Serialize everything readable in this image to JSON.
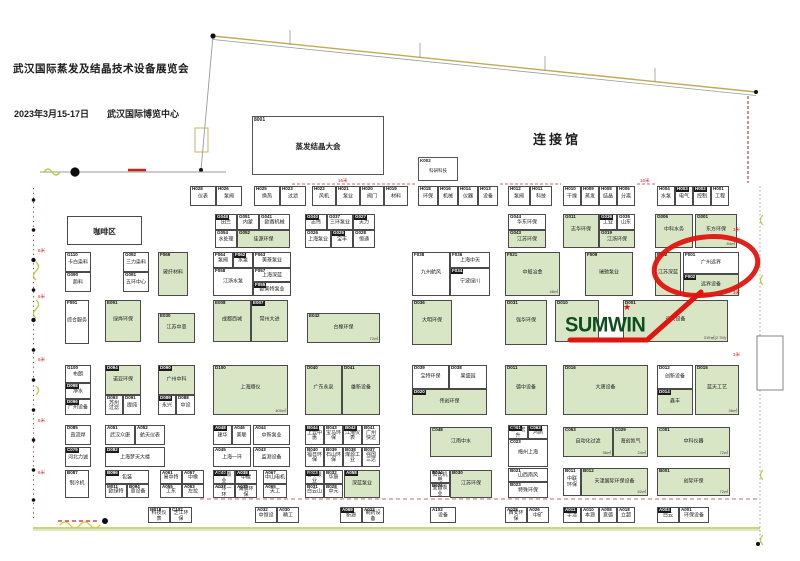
{
  "header": {
    "title": "武汉国际蒸发及结晶技术设备展览会",
    "date": "2023年3月15-17日",
    "venue": "武汉国际博览中心",
    "hall_label": "连接馆"
  },
  "conference": {
    "id": "8001",
    "name": "蒸发结晶大会"
  },
  "kbox": {
    "id": "K002",
    "name": "科研科技"
  },
  "sumwin": {
    "logo": "SUMWIN",
    "star_icon": "★"
  },
  "highlight": {
    "circled_booth": "F001",
    "circled_name": "广州远界"
  },
  "colors": {
    "booth_green": "#d9e6c6",
    "booth_border": "#4a4a4a",
    "highlight_red": "#e01410",
    "logo_green": "#0d4f1f",
    "edge_olive": "#b9c84c",
    "dashed_red": "#bb3333"
  },
  "measures": [
    [
      "16米",
      338,
      178
    ],
    [
      "16米",
      640,
      178
    ],
    [
      "6米",
      38,
      248
    ],
    [
      "6米",
      38,
      294
    ],
    [
      "6米",
      38,
      357
    ],
    [
      "6米",
      38,
      418
    ],
    [
      "6米",
      38,
      470
    ],
    [
      "3米",
      733,
      227
    ],
    [
      "3米",
      733,
      290
    ],
    [
      "3米",
      733,
      352
    ]
  ],
  "booths": [
    [
      "H028",
      "仪表",
      190,
      186,
      26,
      20,
      "w",
      0,
      ""
    ],
    [
      "H026",
      "泵阀",
      216,
      186,
      26,
      20,
      "w",
      0,
      ""
    ],
    [
      "H025",
      "换热",
      254,
      186,
      26,
      20,
      "w",
      0,
      ""
    ],
    [
      "H023",
      "过滤",
      280,
      186,
      26,
      20,
      "w",
      0,
      ""
    ],
    [
      "H022",
      "风机",
      312,
      186,
      24,
      20,
      "w",
      0,
      ""
    ],
    [
      "H021",
      "泵业",
      336,
      186,
      24,
      20,
      "w",
      0,
      ""
    ],
    [
      "H020",
      "阀门",
      360,
      186,
      24,
      20,
      "w",
      0,
      ""
    ],
    [
      "H019",
      "材料",
      384,
      186,
      24,
      20,
      "w",
      0,
      ""
    ],
    [
      "H018",
      "环保",
      418,
      186,
      20,
      20,
      "w",
      0,
      ""
    ],
    [
      "H016",
      "机械",
      438,
      186,
      20,
      20,
      "w",
      0,
      ""
    ],
    [
      "H014",
      "仪器",
      458,
      186,
      20,
      20,
      "w",
      0,
      ""
    ],
    [
      "H013",
      "设备",
      478,
      186,
      20,
      20,
      "w",
      0,
      ""
    ],
    [
      "H012",
      "泵阀",
      508,
      186,
      22,
      20,
      "w",
      0,
      ""
    ],
    [
      "H011",
      "科技",
      530,
      186,
      22,
      20,
      "w",
      0,
      ""
    ],
    [
      "H010",
      "干燥",
      563,
      186,
      18,
      20,
      "w",
      0,
      ""
    ],
    [
      "H009",
      "蒸发",
      581,
      186,
      18,
      20,
      "w",
      0,
      ""
    ],
    [
      "H008",
      "结晶",
      599,
      186,
      18,
      20,
      "w",
      0,
      ""
    ],
    [
      "H006",
      "分离",
      617,
      186,
      18,
      20,
      "w",
      0,
      ""
    ],
    [
      "H004",
      "水泵",
      657,
      186,
      18,
      20,
      "w",
      0,
      ""
    ],
    [
      "H003",
      "电气",
      675,
      186,
      18,
      20,
      "w",
      1,
      ""
    ],
    [
      "H002",
      "控制",
      693,
      186,
      18,
      20,
      "w",
      1,
      ""
    ],
    [
      "H001",
      "工程",
      711,
      186,
      18,
      20,
      "w",
      0,
      ""
    ],
    [
      "",
      "咖啡区",
      67,
      216,
      75,
      29,
      "w",
      2,
      ""
    ],
    [
      "G048",
      "田兰",
      215,
      214,
      22,
      16,
      "w",
      1,
      ""
    ],
    [
      "G051",
      "内蒙",
      237,
      214,
      22,
      16,
      "w",
      0,
      ""
    ],
    [
      "G041",
      "欧赛机械",
      259,
      214,
      31,
      16,
      "w",
      0,
      ""
    ],
    [
      "G054",
      "水处理",
      215,
      230,
      22,
      18,
      "w",
      0,
      ""
    ],
    [
      "G052",
      "佳源环保",
      237,
      230,
      53,
      18,
      "g",
      0,
      ""
    ],
    [
      "G040",
      "志伟",
      305,
      214,
      22,
      16,
      "w",
      1,
      ""
    ],
    [
      "G037",
      "三环泵业",
      327,
      214,
      26,
      16,
      "w",
      0,
      ""
    ],
    [
      "G027",
      "天力",
      353,
      214,
      22,
      16,
      "w",
      1,
      ""
    ],
    [
      "G026",
      "上海泵业",
      305,
      230,
      26,
      18,
      "w",
      0,
      ""
    ],
    [
      "G025",
      "宝丰",
      331,
      230,
      22,
      18,
      "w",
      1,
      ""
    ],
    [
      "G028",
      "恒通",
      353,
      230,
      22,
      18,
      "w",
      0,
      ""
    ],
    [
      "G044",
      "华东环保",
      508,
      214,
      38,
      16,
      "w",
      0,
      ""
    ],
    [
      "G043",
      "江苏环保",
      508,
      230,
      38,
      18,
      "g",
      0,
      ""
    ],
    [
      "G011",
      "志华环保",
      563,
      214,
      36,
      34,
      "g",
      0,
      ""
    ],
    [
      "G036",
      "工业",
      599,
      214,
      18,
      16,
      "w",
      1,
      ""
    ],
    [
      "G035",
      "山东",
      617,
      214,
      18,
      16,
      "w",
      0,
      ""
    ],
    [
      "G019",
      "江浙环保",
      599,
      230,
      36,
      18,
      "g",
      0,
      ""
    ],
    [
      "G006",
      "中科水务",
      655,
      214,
      38,
      34,
      "g",
      0,
      ""
    ],
    [
      "G001",
      "东方环保",
      695,
      214,
      42,
      34,
      "g",
      0,
      "84㎡"
    ],
    [
      "G110",
      "卡白染料",
      65,
      252,
      26,
      20,
      "w",
      0,
      ""
    ],
    [
      "G090",
      "颜料",
      65,
      272,
      26,
      20,
      "w",
      0,
      ""
    ],
    [
      "G092",
      "三力染料",
      123,
      252,
      26,
      20,
      "w",
      0,
      ""
    ],
    [
      "G091",
      "五环中心",
      123,
      272,
      26,
      20,
      "w",
      0,
      ""
    ],
    [
      "F069",
      "玻纤材料",
      158,
      252,
      30,
      44,
      "g",
      0,
      ""
    ],
    [
      "F064",
      "泵阀",
      213,
      252,
      20,
      16,
      "w",
      0,
      ""
    ],
    [
      "F062",
      "水泵",
      233,
      252,
      20,
      16,
      "w",
      1,
      ""
    ],
    [
      "F063",
      "美菱泵业",
      253,
      252,
      38,
      16,
      "w",
      0,
      ""
    ],
    [
      "F058",
      "江浙水泵",
      213,
      268,
      40,
      28,
      "w",
      0,
      ""
    ],
    [
      "F057",
      "上海深蓝",
      253,
      268,
      38,
      14,
      "w",
      0,
      ""
    ],
    [
      "F055",
      "欧美特泵业",
      253,
      282,
      38,
      14,
      "w",
      1,
      ""
    ],
    [
      "F038",
      "九州航风",
      412,
      252,
      38,
      44,
      "w",
      0,
      ""
    ],
    [
      "F036",
      "上海中天",
      450,
      252,
      40,
      16,
      "w",
      0,
      ""
    ],
    [
      "F034",
      "宁波绿川",
      450,
      268,
      40,
      28,
      "w",
      1,
      ""
    ],
    [
      "F021",
      "中船冶金",
      505,
      252,
      55,
      44,
      "g",
      0,
      "48㎡"
    ],
    [
      "F009",
      "瑞驰泵业",
      585,
      252,
      48,
      44,
      "g",
      0,
      ""
    ],
    [
      "F032",
      "江苏深蓝",
      655,
      252,
      26,
      44,
      "g",
      0,
      ""
    ],
    [
      "F001",
      "广州远界",
      683,
      252,
      56,
      22,
      "w",
      0,
      ""
    ],
    [
      "F002",
      "远界设备",
      683,
      274,
      56,
      22,
      "g",
      1,
      ""
    ],
    [
      "F091",
      "综合服务",
      65,
      300,
      24,
      44,
      "w",
      0,
      ""
    ],
    [
      "E091",
      "绿烨环保",
      105,
      300,
      36,
      42,
      "g",
      0,
      ""
    ],
    [
      "E030",
      "江苏中意",
      158,
      313,
      37,
      30,
      "g",
      0,
      ""
    ],
    [
      "E008",
      "成都西城",
      213,
      300,
      38,
      42,
      "g",
      0,
      ""
    ],
    [
      "E007",
      "常州大进",
      251,
      300,
      37,
      42,
      "g",
      1,
      ""
    ],
    [
      "E042",
      "台橡环保",
      307,
      313,
      73,
      30,
      "g",
      0,
      "72㎡"
    ],
    [
      "D036",
      "大明环保",
      412,
      300,
      40,
      45,
      "g",
      0,
      ""
    ],
    [
      "D031",
      "强华环保",
      505,
      300,
      42,
      45,
      "g",
      0,
      ""
    ],
    [
      "D010",
      "",
      555,
      300,
      44,
      42,
      "g",
      0,
      ""
    ],
    [
      "D001",
      "远大设备",
      623,
      300,
      105,
      42,
      "g",
      0,
      "315㎡(2.7M)"
    ],
    [
      "G100",
      "布朗",
      65,
      365,
      26,
      18,
      "w",
      0,
      ""
    ],
    [
      "D098",
      "净水",
      65,
      383,
      26,
      16,
      "w",
      1,
      ""
    ],
    [
      "D096",
      "广州设备",
      65,
      399,
      26,
      16,
      "w",
      1,
      ""
    ],
    [
      "D094",
      "诺亚环保",
      105,
      365,
      36,
      30,
      "g",
      1,
      ""
    ],
    [
      "D093",
      "苏州过滤",
      105,
      395,
      18,
      20,
      "w",
      0,
      ""
    ],
    [
      "D091",
      "提纯",
      123,
      395,
      18,
      20,
      "w",
      0,
      ""
    ],
    [
      "D090",
      "广州中科",
      158,
      365,
      37,
      30,
      "g",
      1,
      ""
    ],
    [
      "D089",
      "永兴",
      158,
      395,
      18,
      20,
      "w",
      1,
      ""
    ],
    [
      "D088",
      "中设",
      176,
      395,
      19,
      20,
      "w",
      0,
      ""
    ],
    [
      "D100",
      "上海顺仪",
      213,
      365,
      75,
      50,
      "g",
      0,
      "400㎡"
    ],
    [
      "D040",
      "广东永泉",
      305,
      365,
      37,
      50,
      "g",
      0,
      ""
    ],
    [
      "D041",
      "雄新设备",
      342,
      365,
      38,
      50,
      "g",
      0,
      ""
    ],
    [
      "D039",
      "宝特环保",
      412,
      365,
      37,
      24,
      "w",
      0,
      ""
    ],
    [
      "D038",
      "果盛园",
      449,
      365,
      38,
      24,
      "w",
      0,
      ""
    ],
    [
      "D020",
      "伟创环保",
      412,
      389,
      75,
      26,
      "g",
      1,
      ""
    ],
    [
      "D011",
      "德中设备",
      505,
      365,
      42,
      50,
      "g",
      0,
      ""
    ],
    [
      "D016",
      "大唐设备",
      563,
      365,
      85,
      50,
      "g",
      0,
      ""
    ],
    [
      "D012",
      "创新设备",
      657,
      365,
      36,
      24,
      "w",
      0,
      ""
    ],
    [
      "D014",
      "鑫丰",
      657,
      389,
      36,
      26,
      "g",
      1,
      ""
    ],
    [
      "D015",
      "蓝天工艺",
      695,
      365,
      44,
      50,
      "g",
      0,
      "36㎡"
    ],
    [
      "D085",
      "直流焊",
      65,
      425,
      26,
      20,
      "w",
      0,
      ""
    ],
    [
      "C079",
      "河北力诚",
      65,
      447,
      26,
      20,
      "w",
      1,
      ""
    ],
    [
      "A051",
      "武汉众康",
      105,
      425,
      30,
      20,
      "w",
      0,
      ""
    ],
    [
      "A052",
      "航天仪表",
      135,
      425,
      30,
      20,
      "w",
      0,
      ""
    ],
    [
      "D082",
      "上海梦天大楼",
      105,
      447,
      60,
      20,
      "w",
      1,
      ""
    ],
    [
      "A048",
      "建华",
      213,
      425,
      19,
      20,
      "w",
      1,
      ""
    ],
    [
      "A046",
      "美联",
      232,
      425,
      19,
      20,
      "w",
      0,
      ""
    ],
    [
      "A045",
      "上海一环",
      213,
      447,
      38,
      20,
      "w",
      0,
      ""
    ],
    [
      "A044",
      "中新泵业",
      253,
      425,
      37,
      20,
      "w",
      0,
      ""
    ],
    [
      "A043",
      "监测设备",
      253,
      447,
      37,
      20,
      "w",
      0,
      ""
    ],
    [
      "B044",
      "上云中惠",
      305,
      425,
      19,
      20,
      "w",
      1,
      ""
    ],
    [
      "B043",
      "宝马环保",
      324,
      425,
      19,
      20,
      "w",
      0,
      ""
    ],
    [
      "B042",
      "江淹仪表",
      343,
      425,
      19,
      20,
      "w",
      1,
      ""
    ],
    [
      "B041",
      "广州快达",
      362,
      425,
      18,
      20,
      "w",
      0,
      ""
    ],
    [
      "B040",
      "福日环保",
      305,
      447,
      19,
      20,
      "w",
      0,
      ""
    ],
    [
      "B039",
      "石山环保",
      324,
      447,
      19,
      20,
      "w",
      0,
      ""
    ],
    [
      "B038",
      "煤源工业",
      343,
      447,
      19,
      20,
      "w",
      0,
      ""
    ],
    [
      "B037",
      "强国三达",
      362,
      447,
      18,
      20,
      "w",
      0,
      ""
    ],
    [
      "C048",
      "江南中水",
      430,
      427,
      62,
      30,
      "g",
      0,
      ""
    ],
    [
      "C061",
      "浙江宏升",
      508,
      425,
      20,
      14,
      "w",
      1,
      ""
    ],
    [
      "C063",
      "鸿鹄",
      528,
      425,
      20,
      14,
      "w",
      1,
      ""
    ],
    [
      "C023",
      "梅州上海",
      508,
      439,
      40,
      28,
      "w",
      0,
      ""
    ],
    [
      "C053",
      "自动化过滤",
      563,
      427,
      50,
      30,
      "g",
      0,
      "36㎡"
    ],
    [
      "C029",
      "海创氮气",
      613,
      427,
      35,
      30,
      "g",
      0,
      "24㎡"
    ],
    [
      "C001",
      "中科仪器",
      657,
      427,
      73,
      30,
      "g",
      0,
      "72㎡"
    ],
    [
      "B087",
      "制冷机",
      65,
      470,
      24,
      28,
      "w",
      0,
      ""
    ],
    [
      "B096",
      "包装",
      105,
      470,
      44,
      14,
      "w",
      1,
      ""
    ],
    [
      "M011",
      "欧绿特",
      105,
      484,
      22,
      14,
      "w",
      0,
      ""
    ],
    [
      "B094",
      "意设备",
      127,
      484,
      22,
      14,
      "w",
      0,
      ""
    ],
    [
      "A061",
      "易中特",
      160,
      470,
      22,
      14,
      "w",
      0,
      ""
    ],
    [
      "A057",
      "中橡",
      182,
      470,
      22,
      14,
      "w",
      0,
      ""
    ],
    [
      "A055",
      "工东",
      160,
      484,
      22,
      14,
      "w",
      0,
      ""
    ],
    [
      "A053",
      "左拉",
      182,
      484,
      22,
      14,
      "w",
      0,
      ""
    ],
    [
      "A040",
      "草中泵业",
      213,
      470,
      22,
      14,
      "w",
      1,
      ""
    ],
    [
      "A038",
      "中碳",
      235,
      470,
      22,
      14,
      "w",
      1,
      ""
    ],
    [
      "A037",
      "一冷一环",
      213,
      484,
      22,
      14,
      "w",
      0,
      ""
    ],
    [
      "A035",
      "海晨环保",
      235,
      484,
      22,
      14,
      "w",
      0,
      ""
    ],
    [
      "A067",
      "中山电机",
      263,
      470,
      24,
      14,
      "w",
      0,
      ""
    ],
    [
      "A065",
      "天工",
      263,
      484,
      24,
      14,
      "w",
      0,
      ""
    ],
    [
      "B033",
      "晋中泵业",
      305,
      470,
      19,
      14,
      "w",
      1,
      ""
    ],
    [
      "B032",
      "华辰",
      324,
      470,
      19,
      14,
      "w",
      0,
      ""
    ],
    [
      "B031",
      "白云山",
      305,
      484,
      19,
      14,
      "w",
      0,
      ""
    ],
    [
      "B028",
      "中元",
      324,
      484,
      19,
      14,
      "w",
      0,
      ""
    ],
    [
      "A058",
      "深蓝泵业",
      344,
      470,
      36,
      28,
      "g",
      1,
      ""
    ],
    [
      "B034",
      "阳氏机电",
      430,
      470,
      20,
      13,
      "w",
      0,
      ""
    ],
    [
      "B026",
      "宜昌泵业",
      430,
      483,
      20,
      14,
      "w",
      0,
      ""
    ],
    [
      "B030",
      "江苏环保",
      450,
      470,
      42,
      28,
      "g",
      0,
      ""
    ],
    [
      "B021",
      "山西南风",
      508,
      468,
      40,
      14,
      "w",
      0,
      ""
    ],
    [
      "B023",
      "特殊环保",
      508,
      482,
      40,
      16,
      "w",
      0,
      ""
    ],
    [
      "B011",
      "中联环保",
      563,
      468,
      18,
      28,
      "w",
      0,
      ""
    ],
    [
      "B012",
      "天津国际环保设备",
      581,
      468,
      67,
      28,
      "g",
      0,
      "52㎡"
    ],
    [
      "B001",
      "创际环保",
      657,
      468,
      73,
      28,
      "g",
      0,
      "72㎡"
    ],
    [
      "M018",
      "科技仪表",
      148,
      507,
      22,
      16,
      "w",
      0,
      ""
    ],
    [
      "C102",
      "芝江环保",
      170,
      507,
      22,
      16,
      "w",
      0,
      ""
    ],
    [
      "A032",
      "中恒设",
      255,
      507,
      22,
      16,
      "w",
      0,
      ""
    ],
    [
      "A030",
      "精工",
      277,
      507,
      22,
      16,
      "w",
      0,
      ""
    ],
    [
      "A069",
      "新源",
      340,
      507,
      22,
      16,
      "w",
      1,
      ""
    ],
    [
      "A023",
      "制药设备",
      362,
      507,
      22,
      16,
      "w",
      0,
      ""
    ],
    [
      "A102",
      "设备",
      430,
      507,
      26,
      16,
      "w",
      0,
      ""
    ],
    [
      "A028",
      "西安环保",
      505,
      507,
      22,
      16,
      "w",
      0,
      ""
    ],
    [
      "A026",
      "中矿",
      527,
      507,
      22,
      16,
      "w",
      0,
      ""
    ],
    [
      "A011",
      "宇清",
      563,
      507,
      18,
      16,
      "w",
      1,
      ""
    ],
    [
      "A010",
      "本源",
      581,
      507,
      18,
      16,
      "w",
      0,
      ""
    ],
    [
      "A008",
      "意德",
      599,
      507,
      18,
      16,
      "w",
      0,
      ""
    ],
    [
      "A018",
      "立超",
      617,
      507,
      18,
      16,
      "w",
      0,
      ""
    ],
    [
      "A003",
      "白云",
      657,
      507,
      22,
      16,
      "w",
      1,
      ""
    ],
    [
      "A001",
      "环保设备",
      679,
      507,
      30,
      16,
      "w",
      0,
      ""
    ]
  ]
}
